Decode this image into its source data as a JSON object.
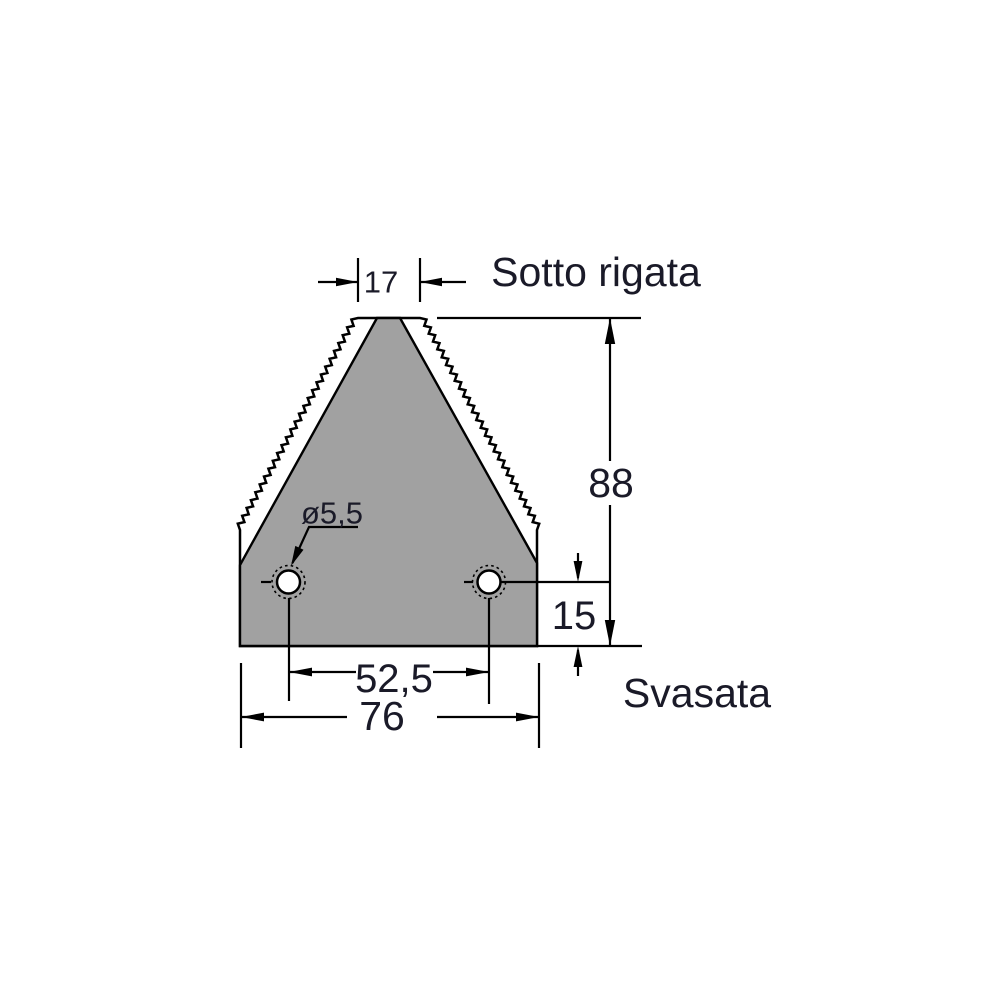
{
  "drawing": {
    "labels": {
      "top_edge": "Sotto rigata",
      "holes": "Svasata"
    },
    "dims": {
      "top_width": "17",
      "total_height": "88",
      "hole_height": "15",
      "hole_spacing": "52,5",
      "base_width": "76",
      "hole_diameter": "ø5,5"
    },
    "colors": {
      "blade_fill": "#a1a1a1",
      "line": "#000000",
      "text": "#1a1a28"
    }
  }
}
